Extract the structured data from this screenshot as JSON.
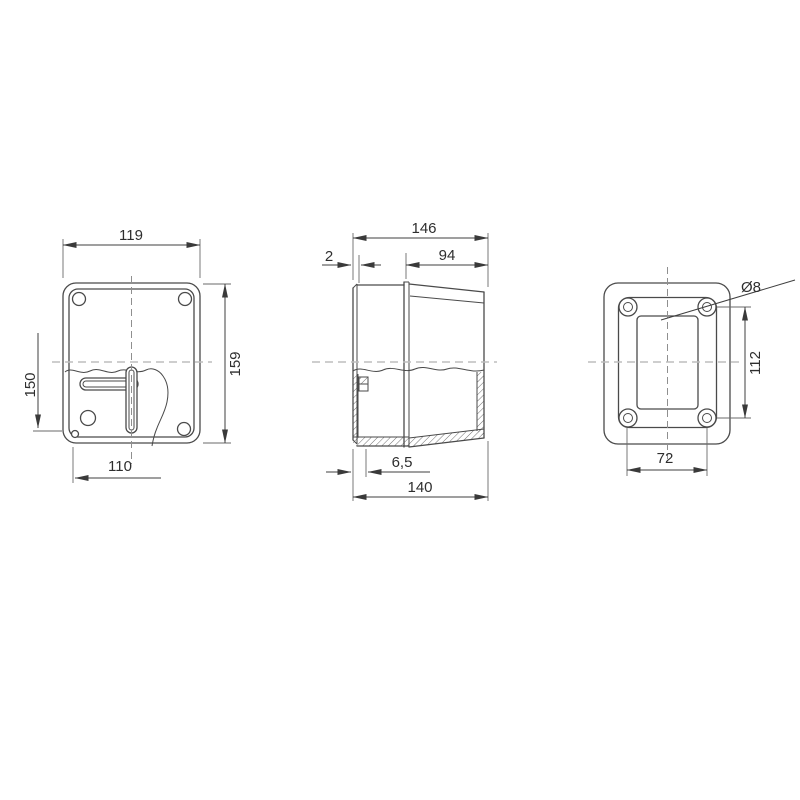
{
  "colors": {
    "background": "#ffffff",
    "outline": "#4a4a4a",
    "dimension_text": "#2e2e2e",
    "centerline_main": "#8f8f8f",
    "centerline_aux": "#bdbdbd"
  },
  "views": {
    "front": {
      "dims": {
        "width": "119",
        "height": "159",
        "fixing_vertical": "150",
        "fixing_horizontal": "110"
      }
    },
    "side": {
      "dims": {
        "depth_total": "146",
        "cover_lip": "2",
        "cover_depth": "94",
        "base_offset": "6,5",
        "base_depth": "140"
      }
    },
    "back": {
      "dims": {
        "hole_diameter": "Ø8",
        "hole_pitch_vertical": "112",
        "hole_pitch_horizontal": "72"
      }
    }
  }
}
